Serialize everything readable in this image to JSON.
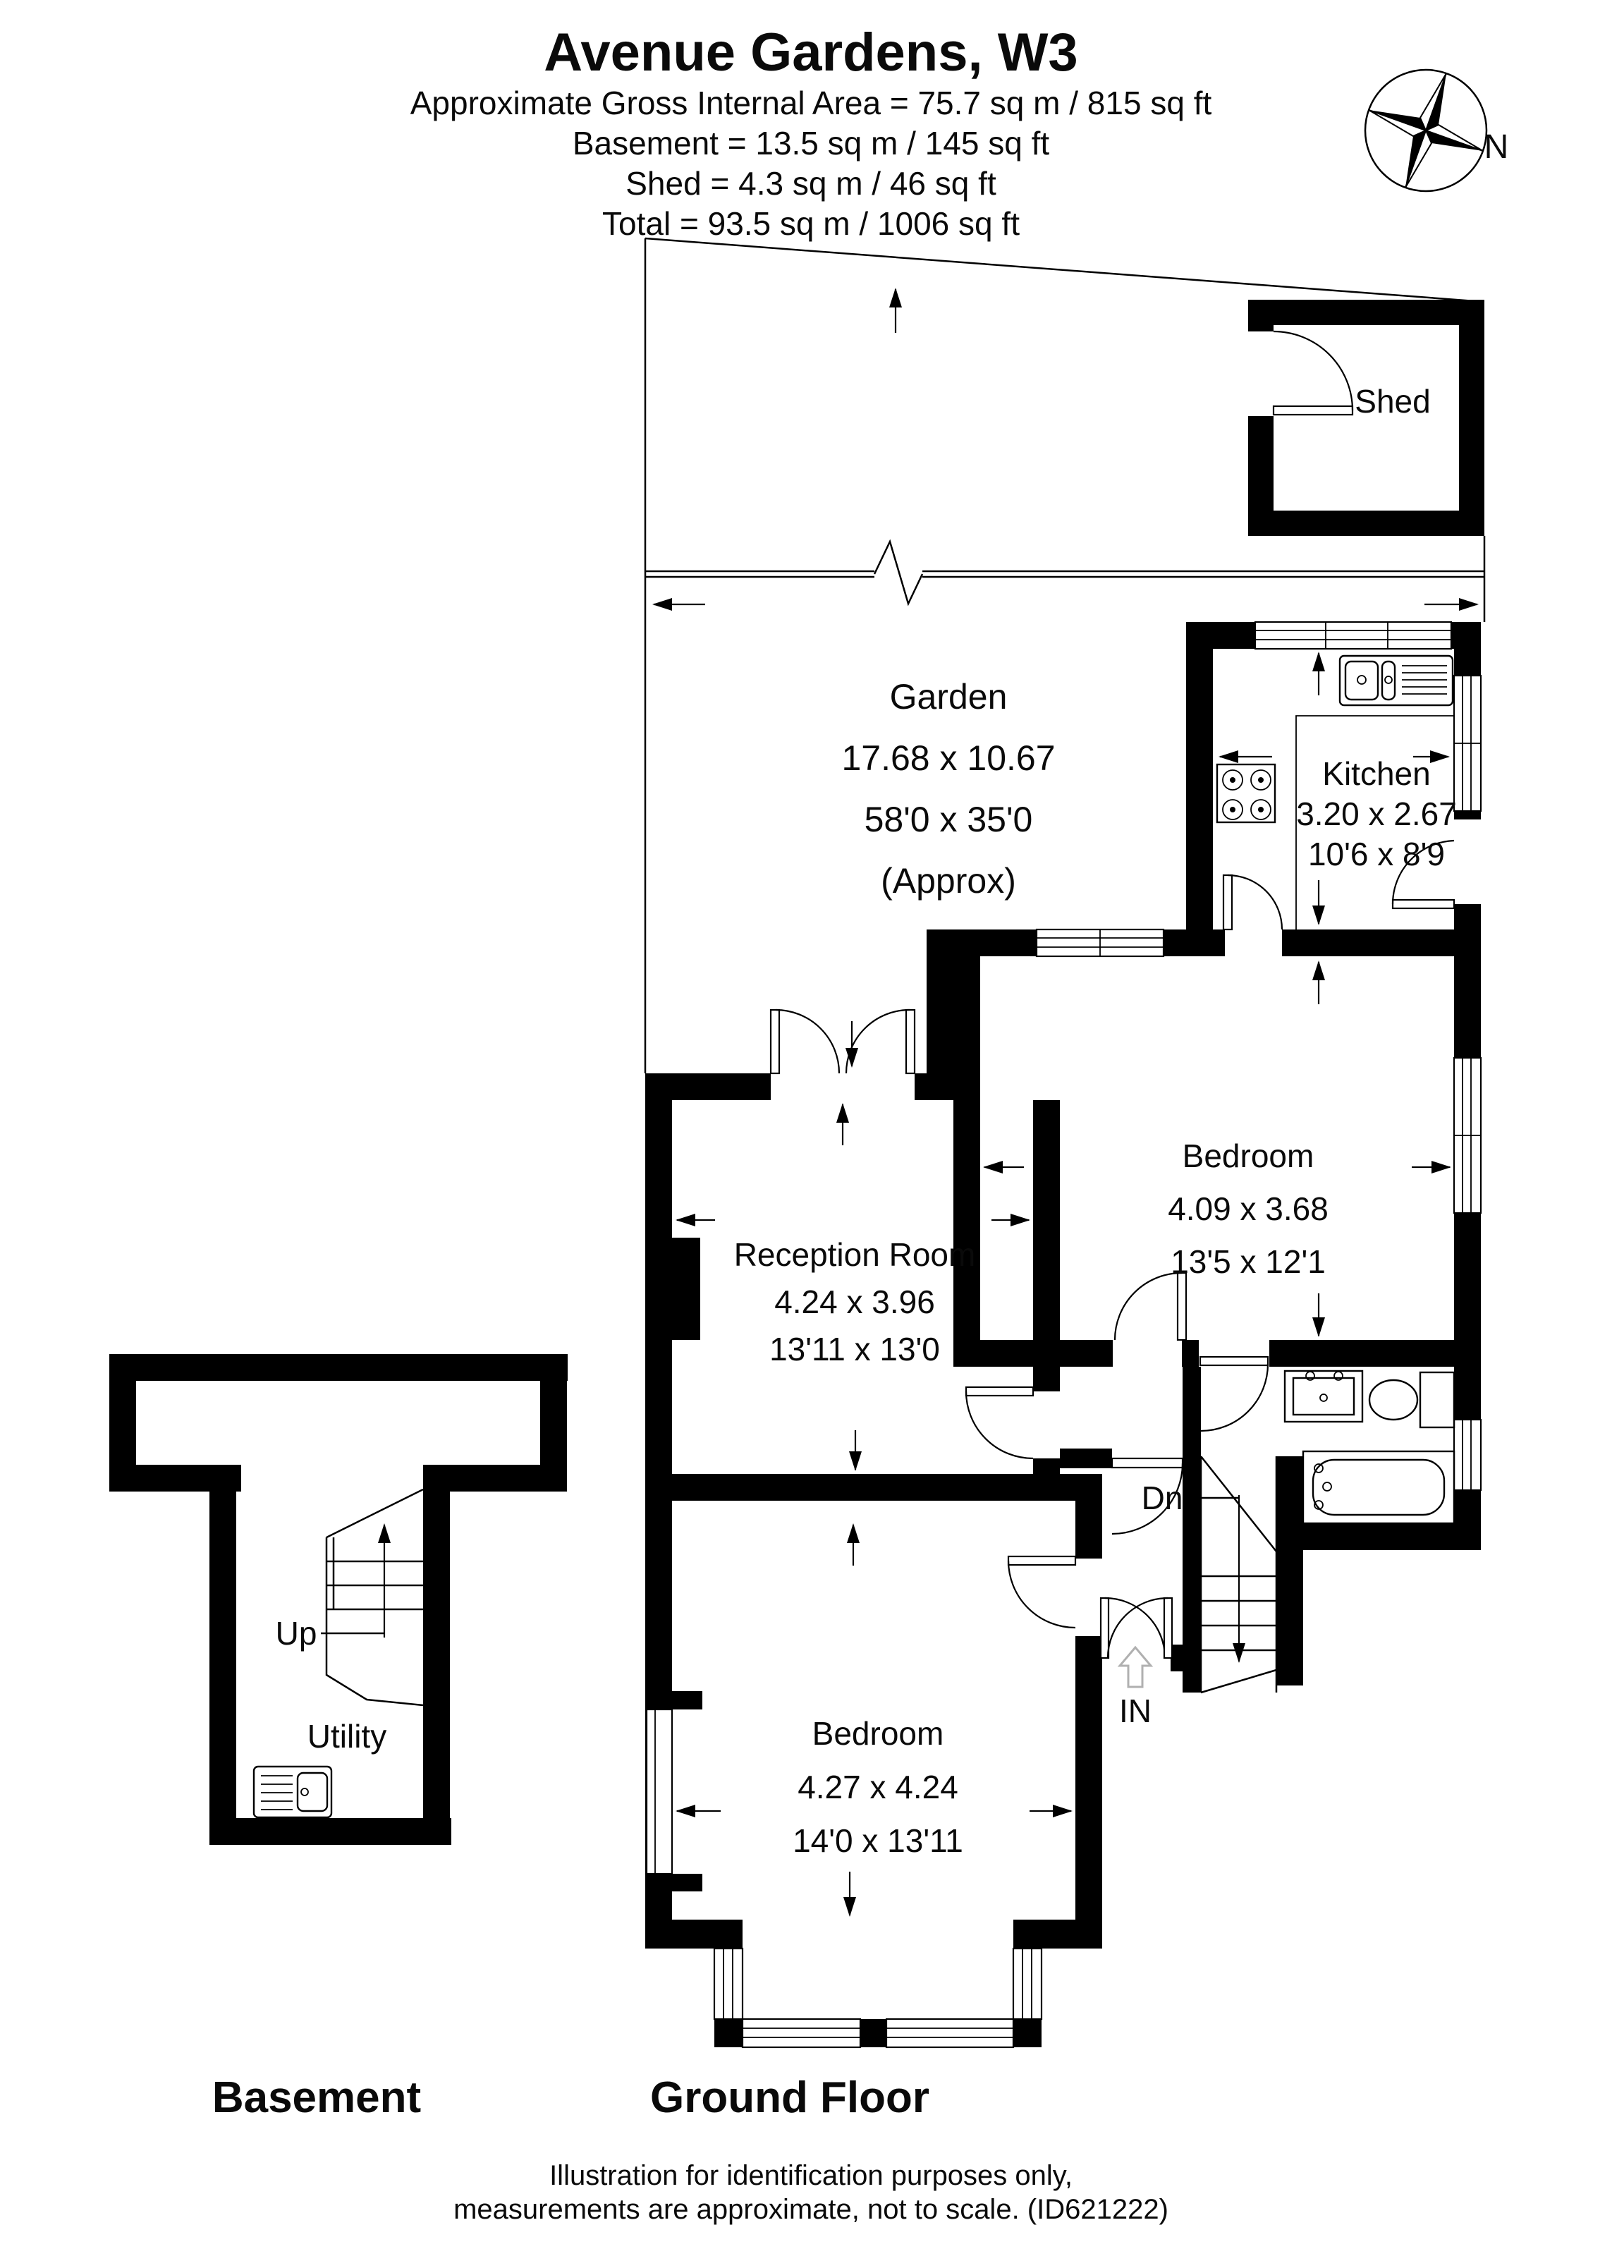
{
  "header": {
    "title": "Avenue Gardens, W3",
    "line1": "Approximate Gross Internal Area = 75.7 sq m / 815 sq ft",
    "line2": "Basement = 13.5 sq m / 145 sq ft",
    "line3": "Shed = 4.3 sq m / 46 sq ft",
    "line4": "Total = 93.5 sq m / 1006 sq ft"
  },
  "compass": {
    "north_label": "N"
  },
  "rooms": {
    "garden": {
      "name": "Garden",
      "dim_metric": "17.68 x 10.67",
      "dim_imperial": "58'0 x 35'0",
      "approx": "(Approx)"
    },
    "shed": {
      "name": "Shed"
    },
    "kitchen": {
      "name": "Kitchen",
      "dim_metric": "3.20 x 2.67",
      "dim_imperial": "10'6 x 8'9"
    },
    "bedroom_rear": {
      "name": "Bedroom",
      "dim_metric": "4.09 x 3.68",
      "dim_imperial": "13'5 x 12'1"
    },
    "reception": {
      "name": "Reception Room",
      "dim_metric": "4.24 x 3.96",
      "dim_imperial": "13'11 x 13'0"
    },
    "bedroom_front": {
      "name": "Bedroom",
      "dim_metric": "4.27 x 4.24",
      "dim_imperial": "14'0 x 13'11"
    },
    "utility": {
      "name": "Utility"
    }
  },
  "annotations": {
    "stairs_down": "Dn",
    "stairs_up": "Up",
    "entrance": "IN"
  },
  "floor_labels": {
    "basement": "Basement",
    "ground": "Ground Floor"
  },
  "footer": {
    "line1": "Illustration for identification purposes only,",
    "line2": "measurements are approximate, not to scale. (ID621222)"
  },
  "colors": {
    "wall": "#000000",
    "line": "#000000",
    "entry_arrow": "#b0b0b0",
    "background": "#ffffff"
  }
}
